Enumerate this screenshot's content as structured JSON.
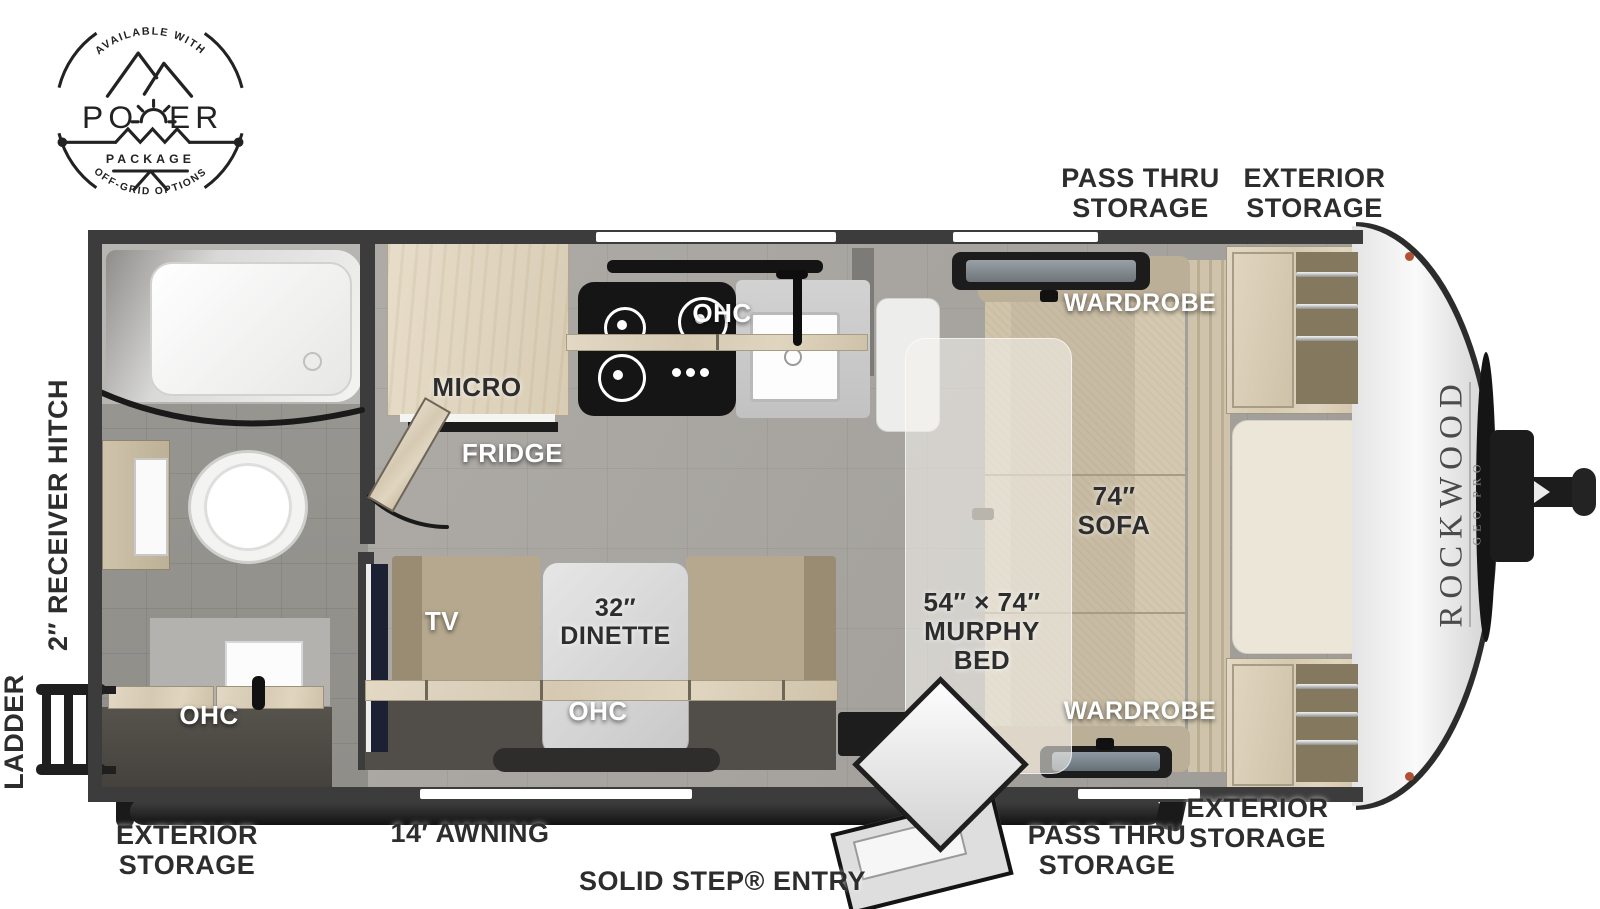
{
  "badge": {
    "arc_top": "AVAILABLE WITH",
    "title": "POWER",
    "title_left": "PO",
    "title_right": "ER",
    "subtitle": "PACKAGE",
    "arc_bottom": "OFF-GRID OPTIONS"
  },
  "brand": {
    "name": "ROCKWOOD",
    "series": "GEO PRO"
  },
  "labels": {
    "pass_thru_storage": "PASS THRU STORAGE",
    "exterior_storage": "EXTERIOR STORAGE",
    "wardrobe": "WARDROBE",
    "ohc": "OHC",
    "micro": "MICRO",
    "fridge": "FRIDGE",
    "tv": "TV",
    "dinette": "32″ DINETTE",
    "sofa": "74″ SOFA",
    "murphy_bed": "54″ × 74″ MURPHY BED",
    "receiver_hitch": "2″ RECEIVER HITCH",
    "ladder": "LADDER",
    "awning": "14′ AWNING",
    "entry": "SOLID STEP® ENTRY"
  },
  "colors": {
    "wall": "#3c3c3c",
    "floor_main": "#a9a6a2",
    "floor_bath": "#96948f",
    "wood": "#d8cdb6",
    "sofa": "#c7bba3",
    "label_dark": "#2d2d2d",
    "label_light": "#ffffff",
    "awning": "#1e1e1e",
    "marker_light": "#b05135"
  }
}
